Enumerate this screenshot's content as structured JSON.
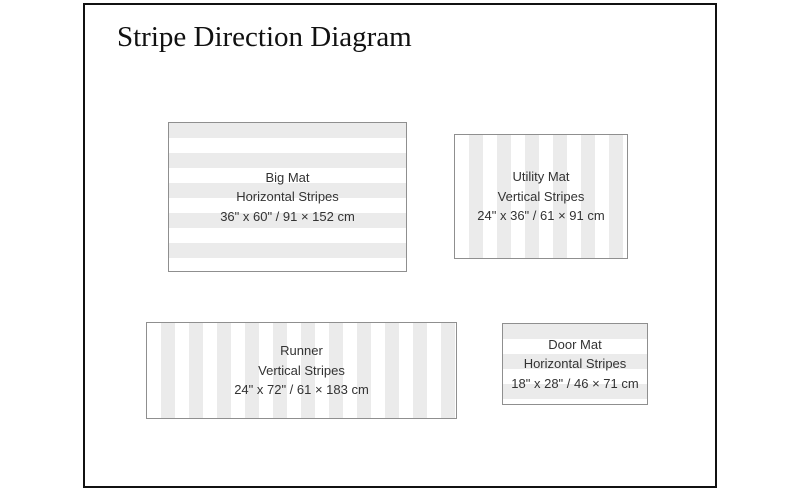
{
  "title": "Stripe Direction Diagram",
  "colors": {
    "stripe_gray": "#ebebeb",
    "mat_background": "#ffffff",
    "mat_border": "#8f8f8f",
    "frame_border": "#111111",
    "label_text": "#333333",
    "title_text": "#111111"
  },
  "mats": [
    {
      "name": "Big Mat",
      "stripe_direction": "Horizontal Stripes",
      "dimensions": "36\" x 60\" / 91 × 152 cm",
      "orientation": "horizontal"
    },
    {
      "name": "Utility Mat",
      "stripe_direction": "Vertical Stripes",
      "dimensions": "24\" x 36\" / 61 × 91 cm",
      "orientation": "vertical"
    },
    {
      "name": "Runner",
      "stripe_direction": "Vertical Stripes",
      "dimensions": "24\" x 72\" / 61 × 183 cm",
      "orientation": "vertical"
    },
    {
      "name": "Door Mat",
      "stripe_direction": "Horizontal Stripes",
      "dimensions": "18\" x 28\" / 46 × 71 cm",
      "orientation": "horizontal"
    }
  ]
}
